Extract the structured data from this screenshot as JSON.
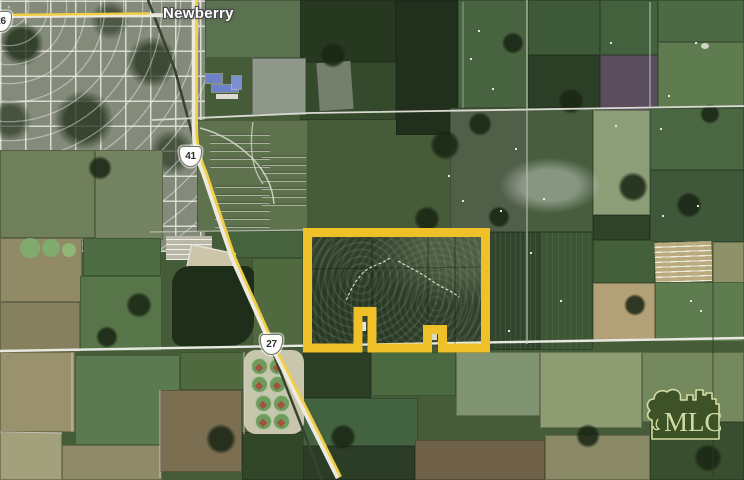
{
  "page": {
    "title": "Newberry, FL aerial parcel map"
  },
  "map": {
    "town_label": "Newberry",
    "shields": {
      "sr26": "26",
      "us41": "41",
      "us27": "27"
    },
    "parcel_outline_color": "#EFC028",
    "highway_color": "#F2CE45",
    "road_color": "#ECEADE"
  },
  "logo": {
    "text": "MLC",
    "background": "#3C5226",
    "foreground": "#D9E0A8"
  }
}
